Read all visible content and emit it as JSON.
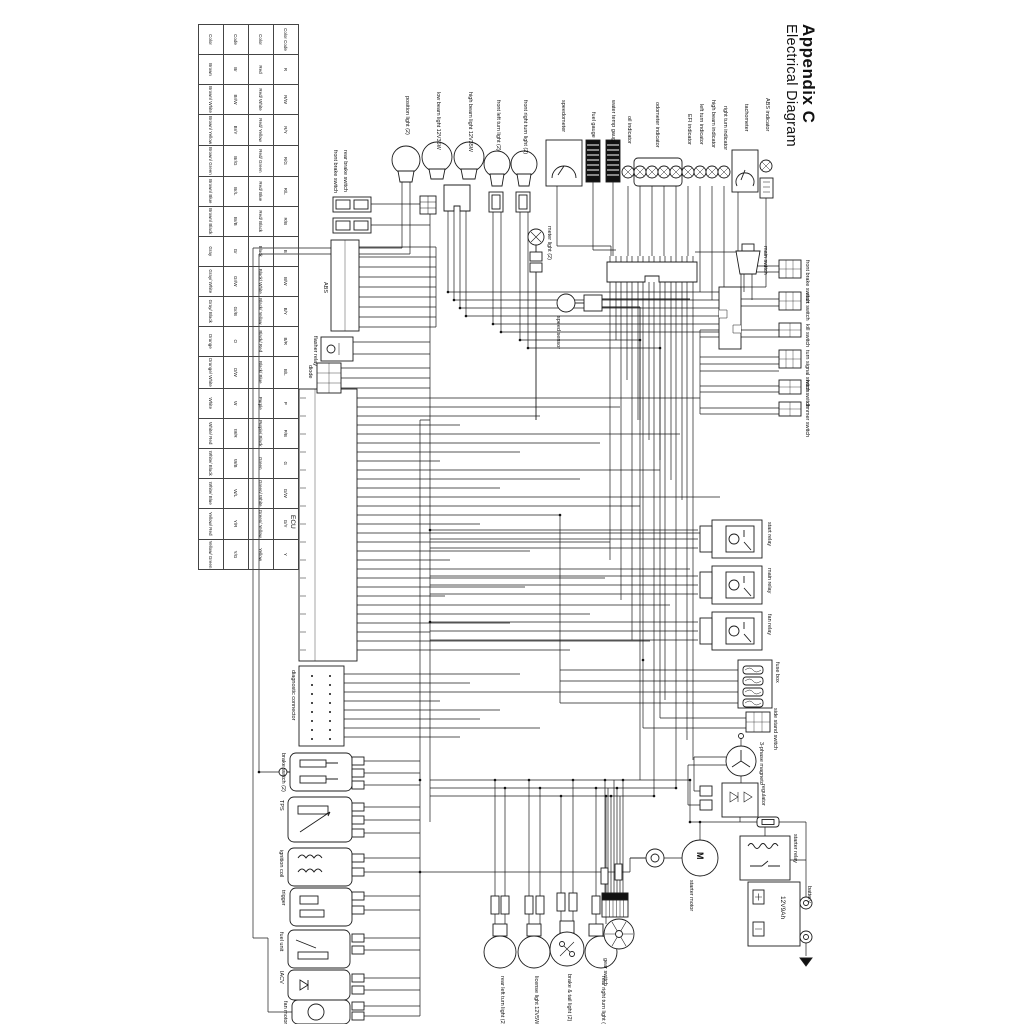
{
  "title": {
    "appendix": "Appendix C",
    "subtitle": "Electrical Diagram"
  },
  "color_table": {
    "rows": [
      [
        "Color Code",
        "R",
        "R/W",
        "R/Y",
        "R/G",
        "R/L",
        "R/B",
        "B",
        "B/W",
        "B/Y",
        "B/R",
        "B/L",
        "P",
        "P/B",
        "G",
        "G/W",
        "G/Y",
        "Y"
      ],
      [
        "Color",
        "Red",
        "Red/ White",
        "Red/ Yellow",
        "Red/ Green",
        "Red/ Blue",
        "Red/ Black",
        "Black",
        "Black/ White",
        "Black/ Yellow",
        "Black/ Red",
        "Black/ Blue",
        "Purple",
        "Purple/ Black",
        "Green",
        "Green/ White",
        "Green/ Yellow",
        "Yellow"
      ],
      [
        "Code",
        "Br",
        "Br/W",
        "Br/Y",
        "Br/G",
        "Br/L",
        "Br/B",
        "Gr",
        "Gr/W",
        "Gr/B",
        "O",
        "O/W",
        "W",
        "W/R",
        "W/B",
        "W/L",
        "Y/R",
        "Y/G"
      ],
      [
        "Color",
        "Brown",
        "Brown/ White",
        "Brown/ Yellow",
        "Brown/ Green",
        "Brown/ Blue",
        "Brown/ Black",
        "Gray",
        "Gray/ White",
        "Gray/ Black",
        "Orange",
        "Orange/ White",
        "White",
        "White/ Red",
        "White/ Black",
        "White/ Blue",
        "Yellow/ Red",
        "Yellow/ Green"
      ]
    ]
  },
  "top_lights": [
    "position light (2)",
    "low beam light 12V35W",
    "high beam light 12V35W",
    "front left turn light (2)",
    "front right turn light (2)"
  ],
  "meter": [
    "speedometer",
    "fuel gauge",
    "water temp gauge",
    "oil indicator",
    "odometer indicator",
    "EFI indicator",
    "left turn indicator",
    "high beam indicator",
    "right turn indicator",
    "tachometer",
    "ABS indicator"
  ],
  "mid": {
    "meter_light": "meter light (2)",
    "speed_sensor": "speed sensor"
  },
  "left": {
    "front_brake": "front brake switch",
    "rear_brake": "rear brake switch",
    "abs": "ABS",
    "flasher": "flasher relay",
    "diode": "diode",
    "ecu": "ECU",
    "diag": "diagnostic connector"
  },
  "bottom_left": [
    "brake switch (2)",
    "TPS",
    "ignition coil",
    "trigger",
    "fuel unit",
    "IACV",
    "fan motor"
  ],
  "bottom_lights": [
    "rear left turn light (2)",
    "license light 12V5W",
    "brake & tail light (2)",
    "rear right turn light (2)"
  ],
  "gear": "gear switch",
  "right": {
    "main_switch": "main switch",
    "switches": [
      "front brake switch",
      "start switch",
      "kill switch",
      "turn signal switch",
      "horn switch",
      "dimmer switch"
    ],
    "relays": [
      "start relay",
      "main relay",
      "fan relay"
    ],
    "fuse_box": "fuse box",
    "side_stand": "side stand switch",
    "magneto": "3-phase magneto",
    "regulator": "regulator",
    "starter_relay": "starter relay",
    "starter_motor": "starter motor",
    "motor_symbol": "M",
    "battery": "battery",
    "battery_spec": "12V9Ah"
  }
}
